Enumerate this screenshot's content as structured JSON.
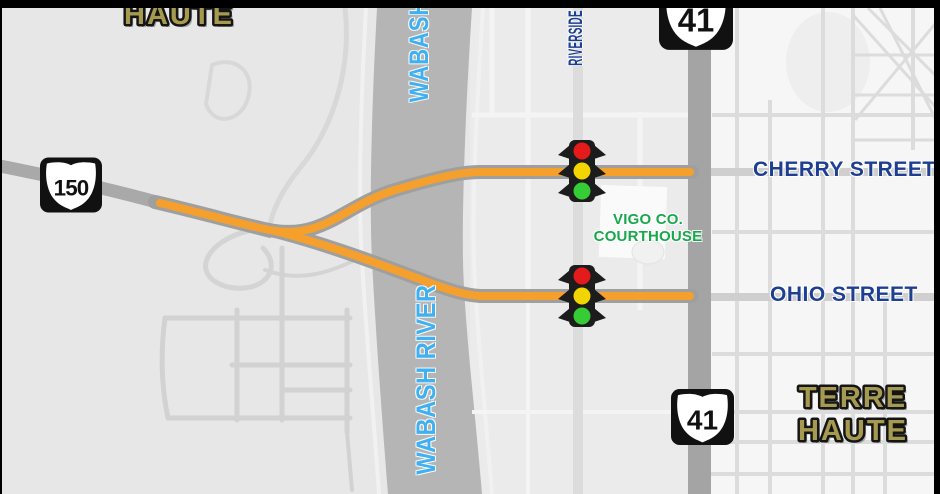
{
  "map": {
    "region": "Terre Haute, Indiana street map",
    "labels": {
      "haute_top": "HAUTE",
      "terre": "TERRE",
      "haute": "HAUTE",
      "wabash": "WABASH",
      "wabash_river": "WABASH RIVER",
      "riverside": "RIVERSIDE",
      "cherry_street": "CHERRY STREET",
      "ohio_street": "OHIO STREET",
      "courthouse_line1": "VIGO CO.",
      "courthouse_line2": "COURTHOUSE"
    },
    "shields": {
      "us150": "150",
      "us41_top": "41",
      "us41_bottom": "41"
    },
    "icons": {
      "traffic_signal": "traffic-signal-icon",
      "route_shield": "us-route-shield-icon"
    },
    "colors": {
      "label_navy": "#1d3e91",
      "label_sky_blue": "#3fb0f2",
      "label_green": "#17a84b",
      "label_gold": "#a59a50",
      "route_orange": "#f5a02d",
      "road_casing_gray": "#9f9f9f",
      "highway_gray": "#a4a4a4",
      "river_gray": "#b5b5b5",
      "signal_red": "#e51a1a",
      "signal_yellow": "#f2d500",
      "signal_green": "#35cc35",
      "frame_black": "#000000"
    }
  }
}
